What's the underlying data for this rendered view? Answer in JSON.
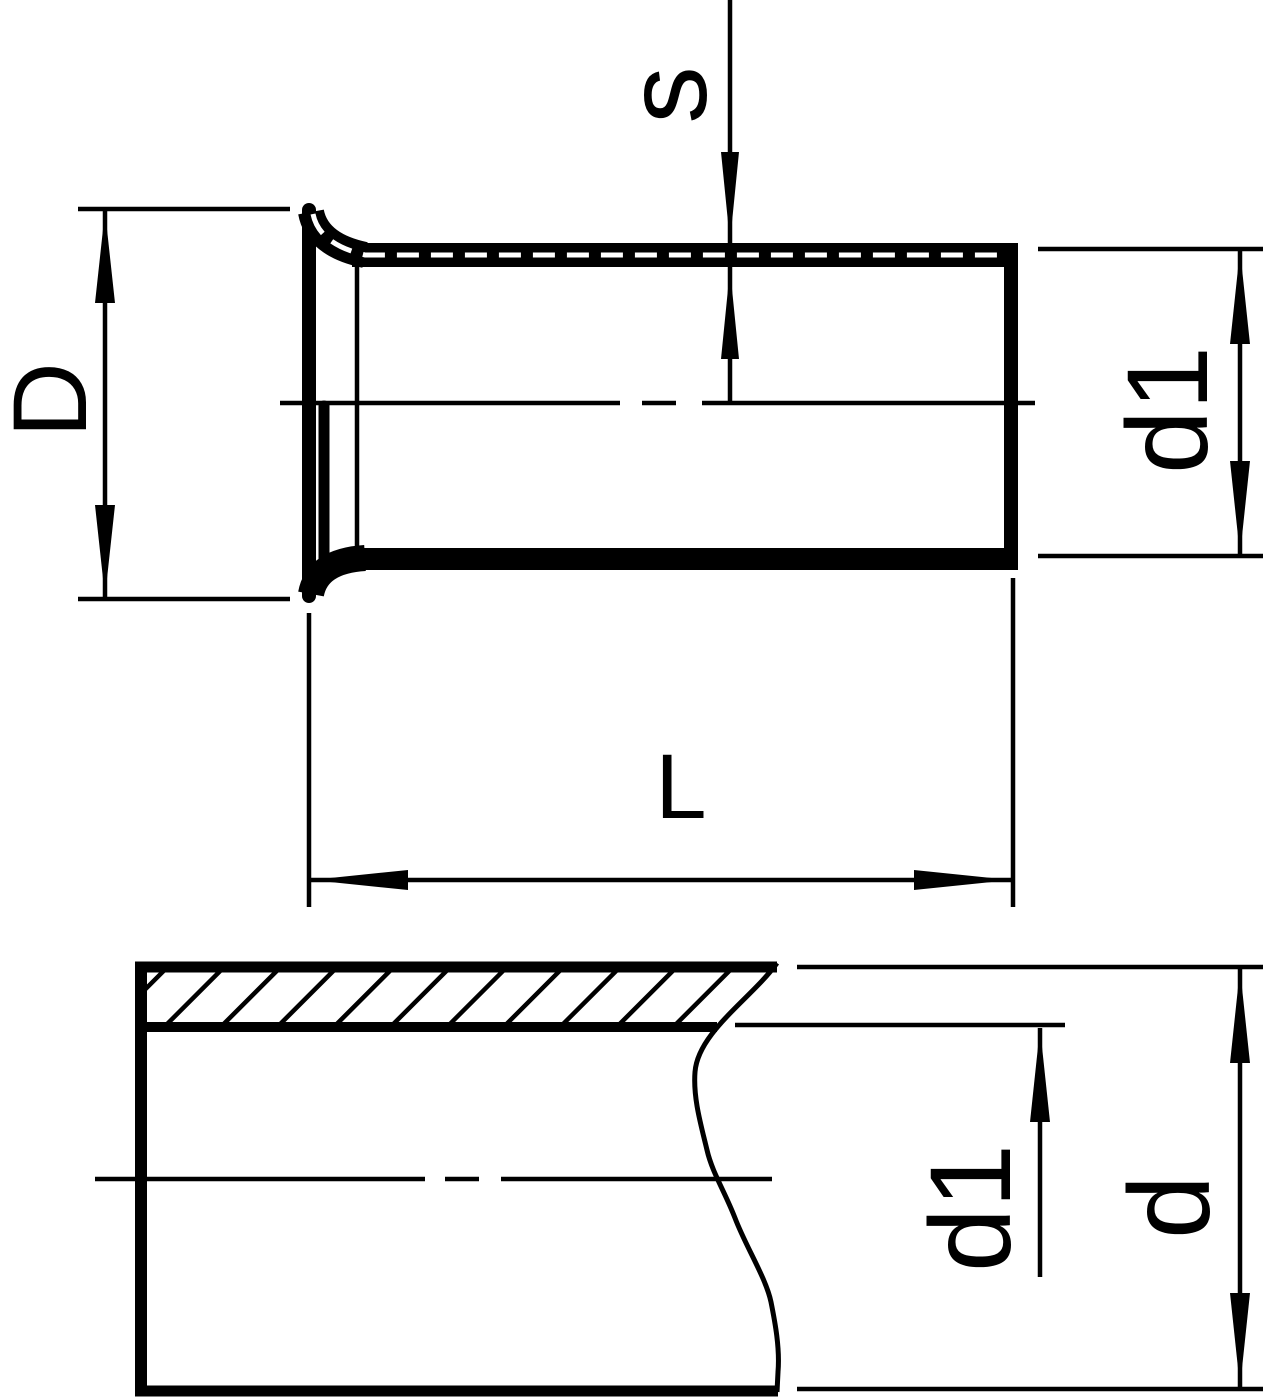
{
  "drawing": {
    "kind": "technical dimension drawing, black line art on white",
    "colors": {
      "line": "#000000",
      "background": "#ffffff"
    },
    "top_view": {
      "labels": {
        "flange_outer_diameter": "D",
        "wall_thickness": "s",
        "sleeve_inner_diameter": "d1",
        "sleeve_length": "L"
      }
    },
    "bottom_view": {
      "labels": {
        "pipe_inner_diameter": "d1",
        "pipe_outer_diameter": "d"
      }
    }
  }
}
